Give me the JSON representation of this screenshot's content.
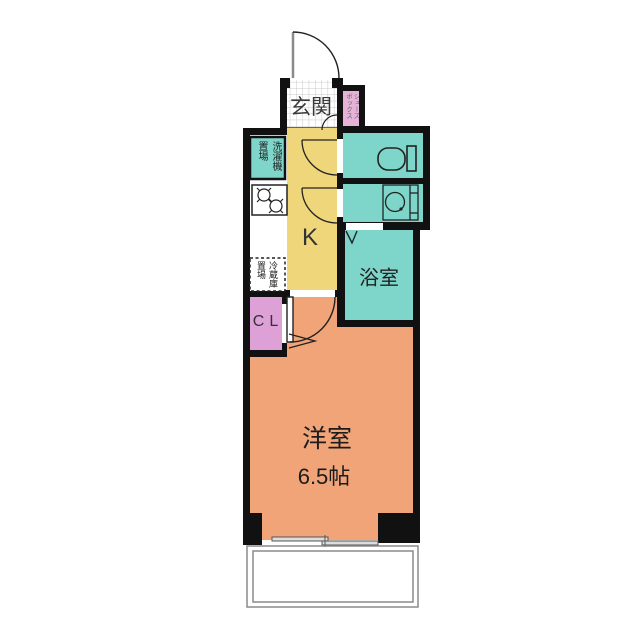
{
  "plan": {
    "type": "japanese-apartment-floorplan",
    "rooms": {
      "entrance": {
        "label": "玄関"
      },
      "kitchen": {
        "label": "K"
      },
      "bathroom": {
        "label": "浴室"
      },
      "closet": {
        "label": "CL"
      },
      "western_room": {
        "label": "洋室",
        "size": "6.5帖"
      }
    },
    "annotations": {
      "shoe_box": "シューズボックス",
      "washer_space": "洗濯機置場",
      "fridge_space": "冷蔵庫置場"
    },
    "fixtures": [
      "entrance-door-icon",
      "stove-burners-icon",
      "toilet-icon",
      "washbasin-icon",
      "bath-door-icon",
      "room-door-icon",
      "closet-folding-door-icon",
      "sliding-window-icon",
      "balcony-outline"
    ],
    "colors": {
      "wall": "#111111",
      "water_rooms": "#7dd6c9",
      "kitchen": "#f0d67a",
      "western_room": "#f0a478",
      "shoe_box": "#e6b2d7",
      "closet": "#dda0d7",
      "tile_line": "#c9c9c9",
      "background": "#ffffff"
    }
  }
}
